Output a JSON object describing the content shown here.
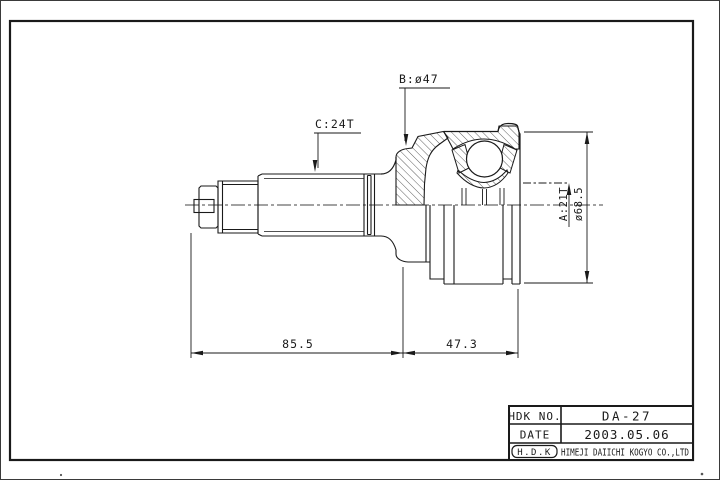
{
  "sheet": {
    "background": "#ffffff",
    "ink": "#1a1a1a",
    "description": "CV joint outer race technical drawing"
  },
  "dims": {
    "b": "B:ø47",
    "c": "C:24T",
    "a": "A:21T",
    "outer_dia": "ø68.5",
    "len_left": "85.5",
    "len_right": "47.3"
  },
  "title_block": {
    "no_label": "HDK NO.",
    "no_value": "DA-27",
    "date_label": "DATE",
    "date_value": "2003.05.06",
    "logo": "H.D.K",
    "company": "HIMEJI DAIICHI KOGYO CO.,LTD"
  }
}
